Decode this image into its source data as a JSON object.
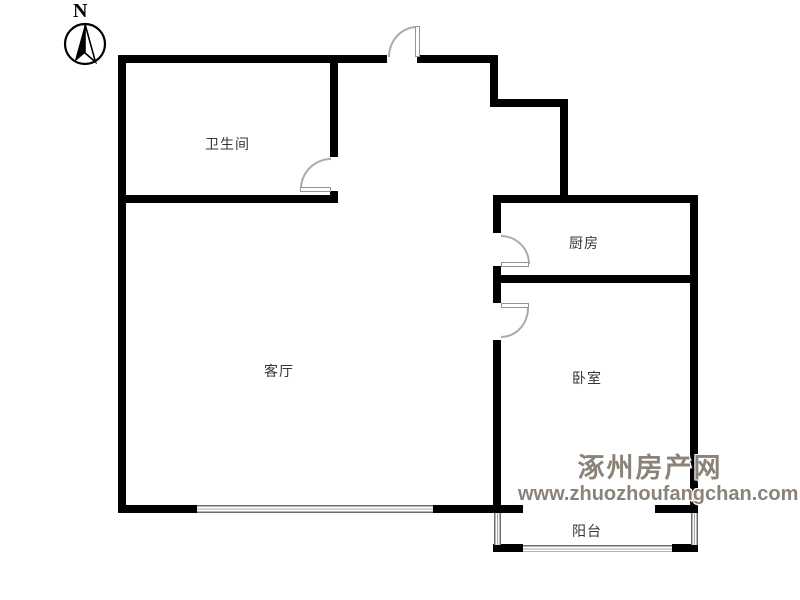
{
  "compass": {
    "north_label": "N"
  },
  "rooms": {
    "bathroom": {
      "label": "卫生间"
    },
    "kitchen": {
      "label": "厨房"
    },
    "living_room": {
      "label": "客厅"
    },
    "bedroom": {
      "label": "卧室"
    },
    "balcony": {
      "label": "阳台"
    }
  },
  "watermark": {
    "site_name": "涿州房产网",
    "site_url": "www.zhuozhoufangchan.com",
    "color": "#8b827a"
  },
  "colors": {
    "wall": "#000000",
    "door_swing": "#ababab",
    "window_line": "#6e6e6e",
    "label_text": "#353535",
    "background": "#ffffff"
  }
}
